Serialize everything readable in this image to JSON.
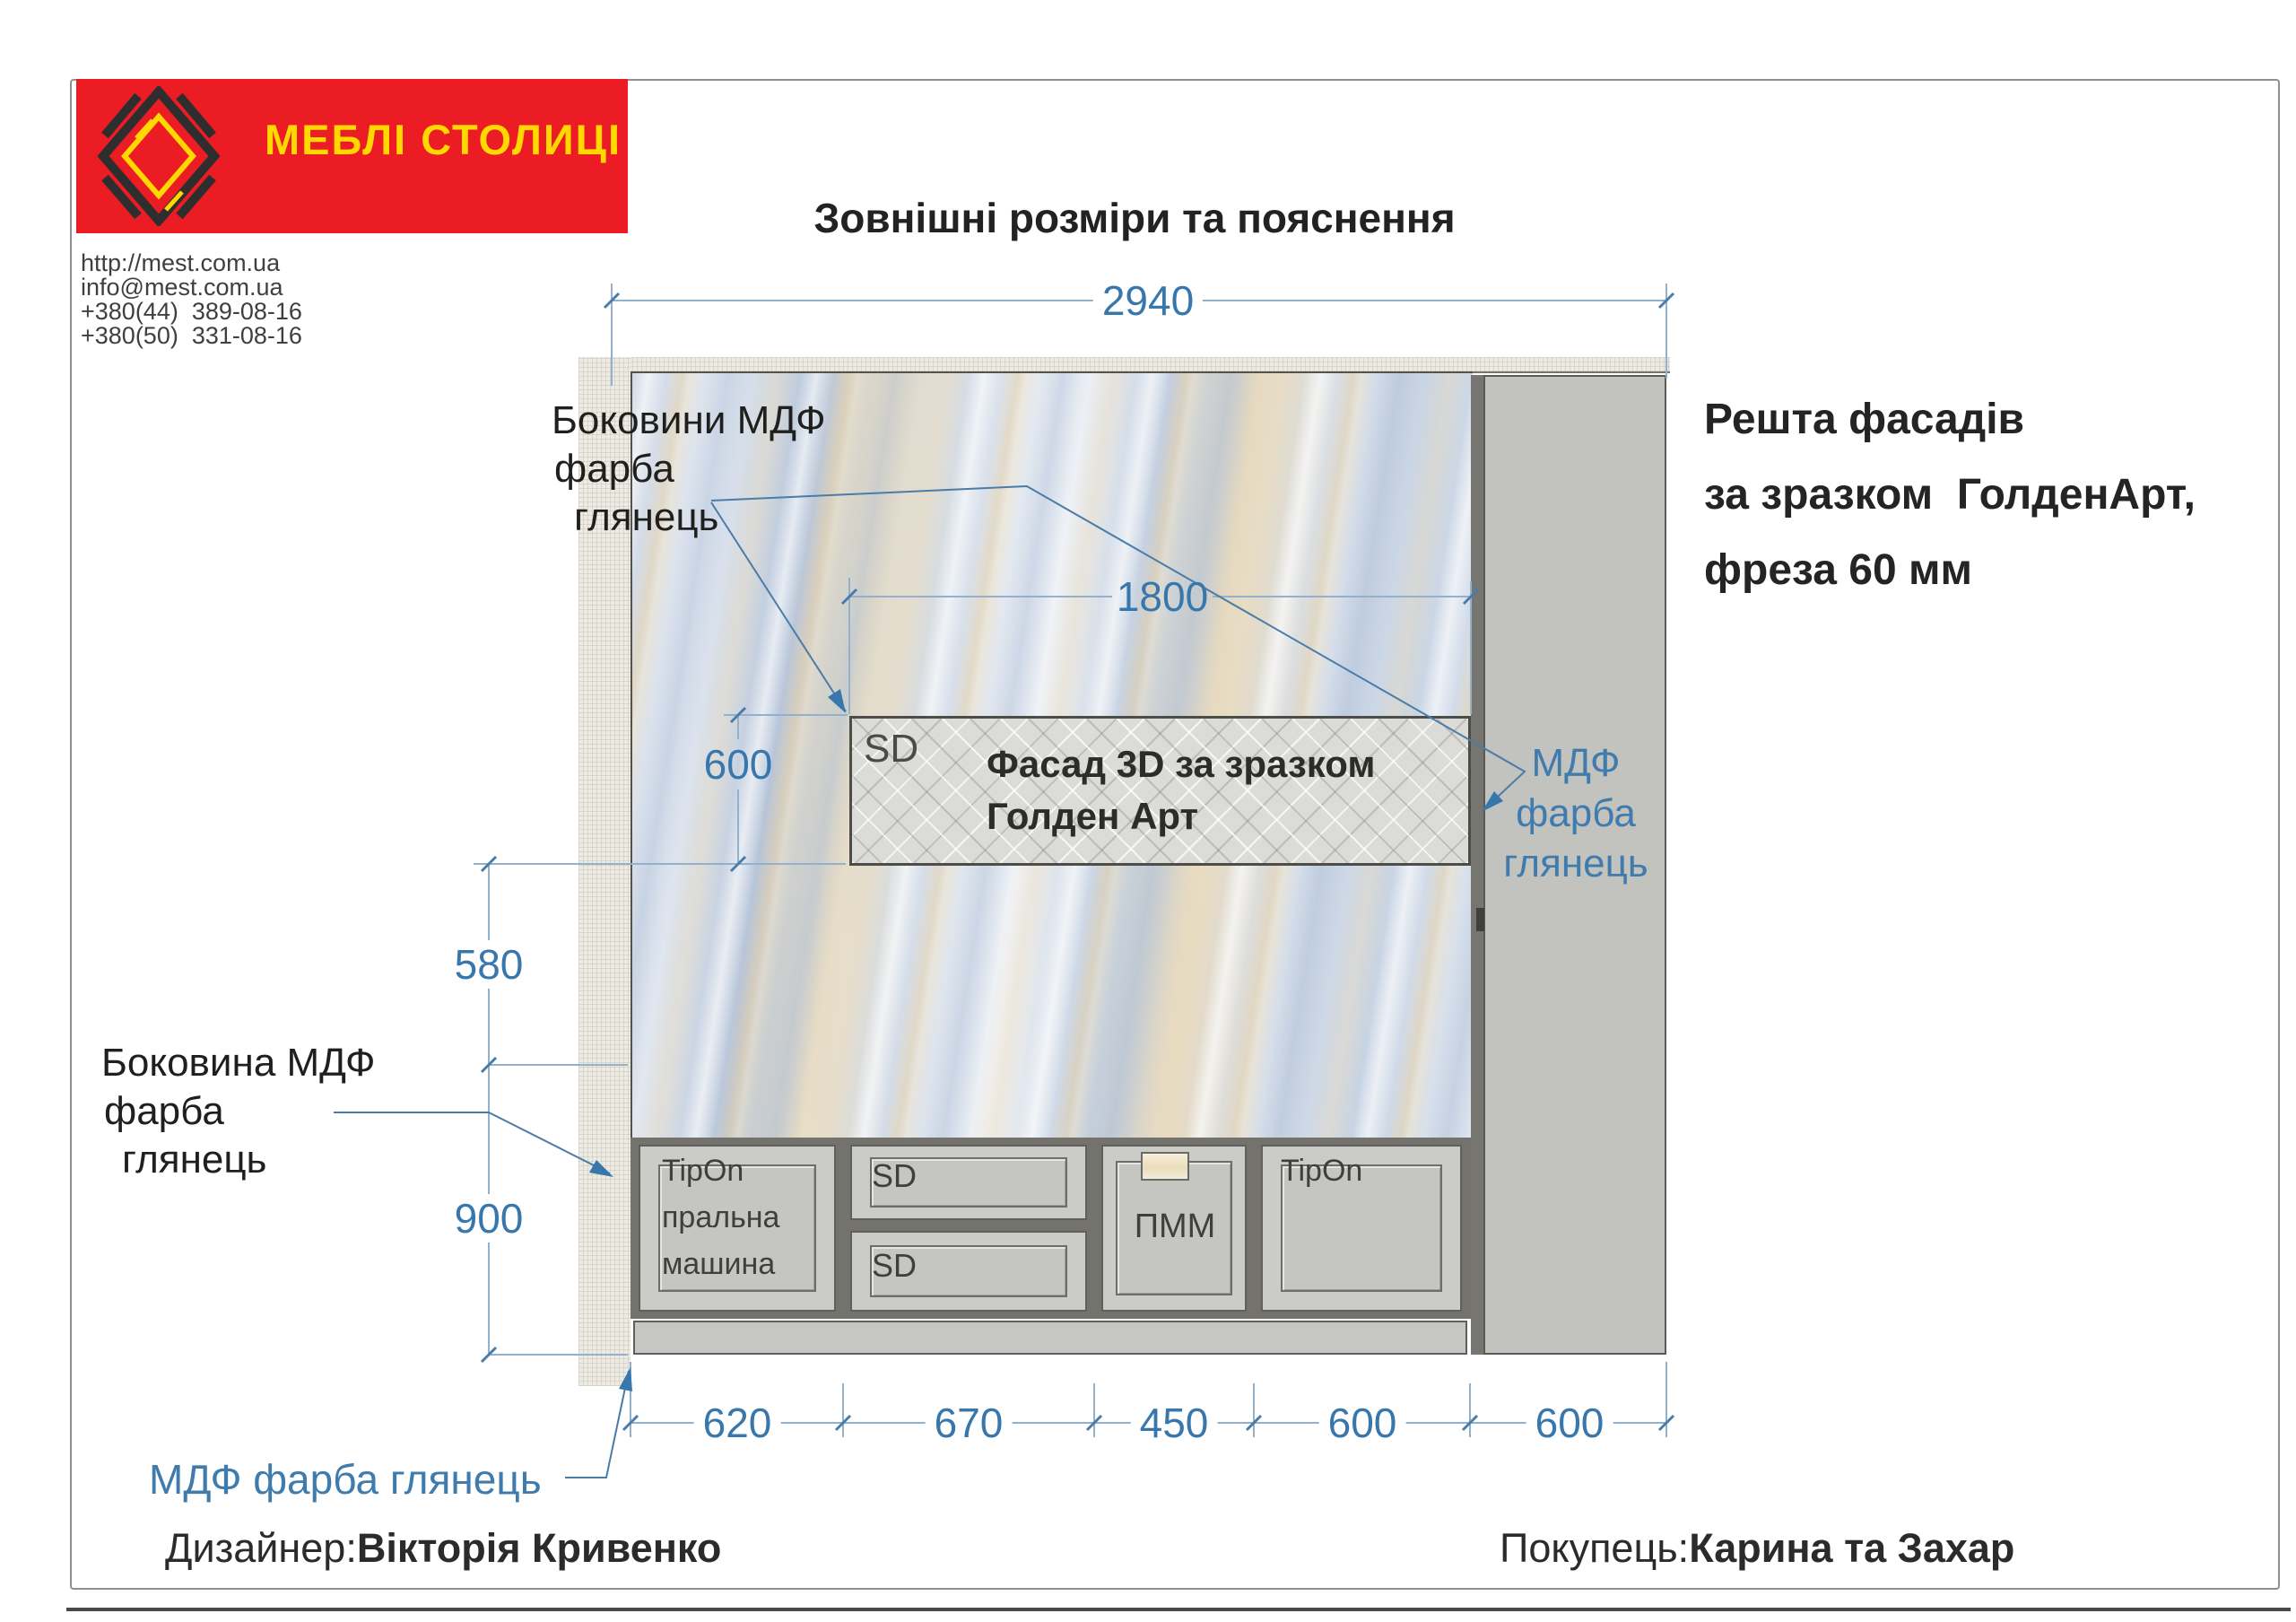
{
  "brand": {
    "name": "МЕБЛІ СТОЛИЦІ",
    "bg_color": "#ec1c24",
    "text_color": "#ffd800"
  },
  "contact": {
    "lines": [
      "http://mest.com.ua",
      "info@mest.com.ua",
      "+380(44)  389-08-16",
      "+380(50)  331-08-16"
    ]
  },
  "title": "Зовнішні розміри та пояснення",
  "notes": {
    "sides_top": {
      "lines": [
        "Боковини МДФ",
        "фарба",
        "глянець"
      ]
    },
    "side_left": {
      "lines": [
        "Боковина МДФ",
        "фарба",
        "глянець"
      ]
    },
    "rest_fronts": {
      "lines": [
        "Решта фасадів",
        "за зразком  ГолденАрт,",
        "фреза 60 мм"
      ]
    },
    "mdf_right": {
      "lines": [
        "МДФ",
        "фарба",
        "глянець"
      ]
    },
    "mdf_bottom": "МДФ фарба глянець"
  },
  "facade_panel": {
    "tag": "SD",
    "lines": [
      "Фасад 3D за зразком",
      "Голден Арт"
    ]
  },
  "cabinets": {
    "washer": {
      "lines": [
        "TipOn",
        "пральна",
        "машина"
      ]
    },
    "drawer_top": "SD",
    "drawer_bottom": "SD",
    "dishwasher": "ПММ",
    "right_door": "TipOn"
  },
  "dimensions": {
    "total_width": "2940",
    "facade_width": "1800",
    "facade_height": "600",
    "splash_height": "580",
    "base_height": "900",
    "bottom": [
      "620",
      "670",
      "450",
      "600",
      "600"
    ]
  },
  "footer": {
    "designer_label": "Дизайнер:",
    "designer_name": "Вікторія Кривенко",
    "customer_label": "Покупець:",
    "customer_name": "Карина та Захар"
  },
  "colors": {
    "accent_red": "#ec1c24",
    "brand_yellow": "#ffd800",
    "dim_blue": "#3877ac",
    "dim_line": "#93b1ca"
  }
}
